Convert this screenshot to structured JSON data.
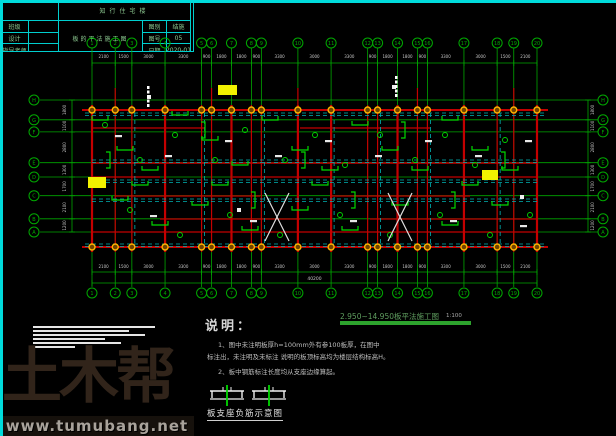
{
  "colors": {
    "grid_green": "#00a800",
    "bright_green": "#00d800",
    "beam_red": "#c40000",
    "slab_cyan": "#00b4b4",
    "column_orange": "#ffb400",
    "highlight_yellow": "#f2f200",
    "dim_text": "#c8c8c8",
    "title_green": "#2da32d",
    "frame_cyan": "#00dcdc"
  },
  "axes": {
    "col_labels": [
      "1",
      "2",
      "3",
      "4",
      "5",
      "6",
      "7",
      "8",
      "9",
      "10",
      "11",
      "12",
      "13",
      "14",
      "15",
      "16",
      "17",
      "18",
      "19",
      "20"
    ],
    "col_dims": [
      2100,
      1500,
      3000,
      3300,
      900,
      1800,
      1800,
      900,
      3300,
      3000,
      3300,
      900,
      1800,
      1800,
      900,
      3300,
      3000,
      1500,
      2100
    ],
    "col_total": "40200",
    "row_labels_top_to_bottom": [
      "H",
      "G",
      "F",
      "E",
      "D",
      "C",
      "B",
      "A"
    ],
    "row_dims": [
      1800,
      1100,
      2800,
      1300,
      1700,
      2100,
      1200
    ]
  },
  "plan_title": {
    "text": "2.950~14.950板平法施工图",
    "scale": "1:100"
  },
  "notes": {
    "heading": "说明：",
    "line1": "1、图中未注明板厚h=100mm外有参100板厚，在图中",
    "line2": "标注出，未注明及未标注 说明的板顶标高均为楼层结构标高H。",
    "line3": "2、板中钢筋标注长度均从支座边缘算起。"
  },
  "detail": {
    "caption": "板支座负筋示意图"
  },
  "watermark": {
    "logo": "土木帮",
    "url": "www.tumubang.net"
  },
  "title_block": {
    "project": "知行住宅楼",
    "drawing_name": "板的平法施工图",
    "left_rows": [
      {
        "label": "班级",
        "value": ""
      },
      {
        "label": "设计",
        "value": ""
      },
      {
        "label": "指导老师",
        "value": ""
      }
    ],
    "meta_rows": [
      {
        "label": "图别",
        "value": "结施"
      },
      {
        "label": "图号",
        "value": "05"
      },
      {
        "label": "日期",
        "value": "2020-01"
      }
    ]
  }
}
